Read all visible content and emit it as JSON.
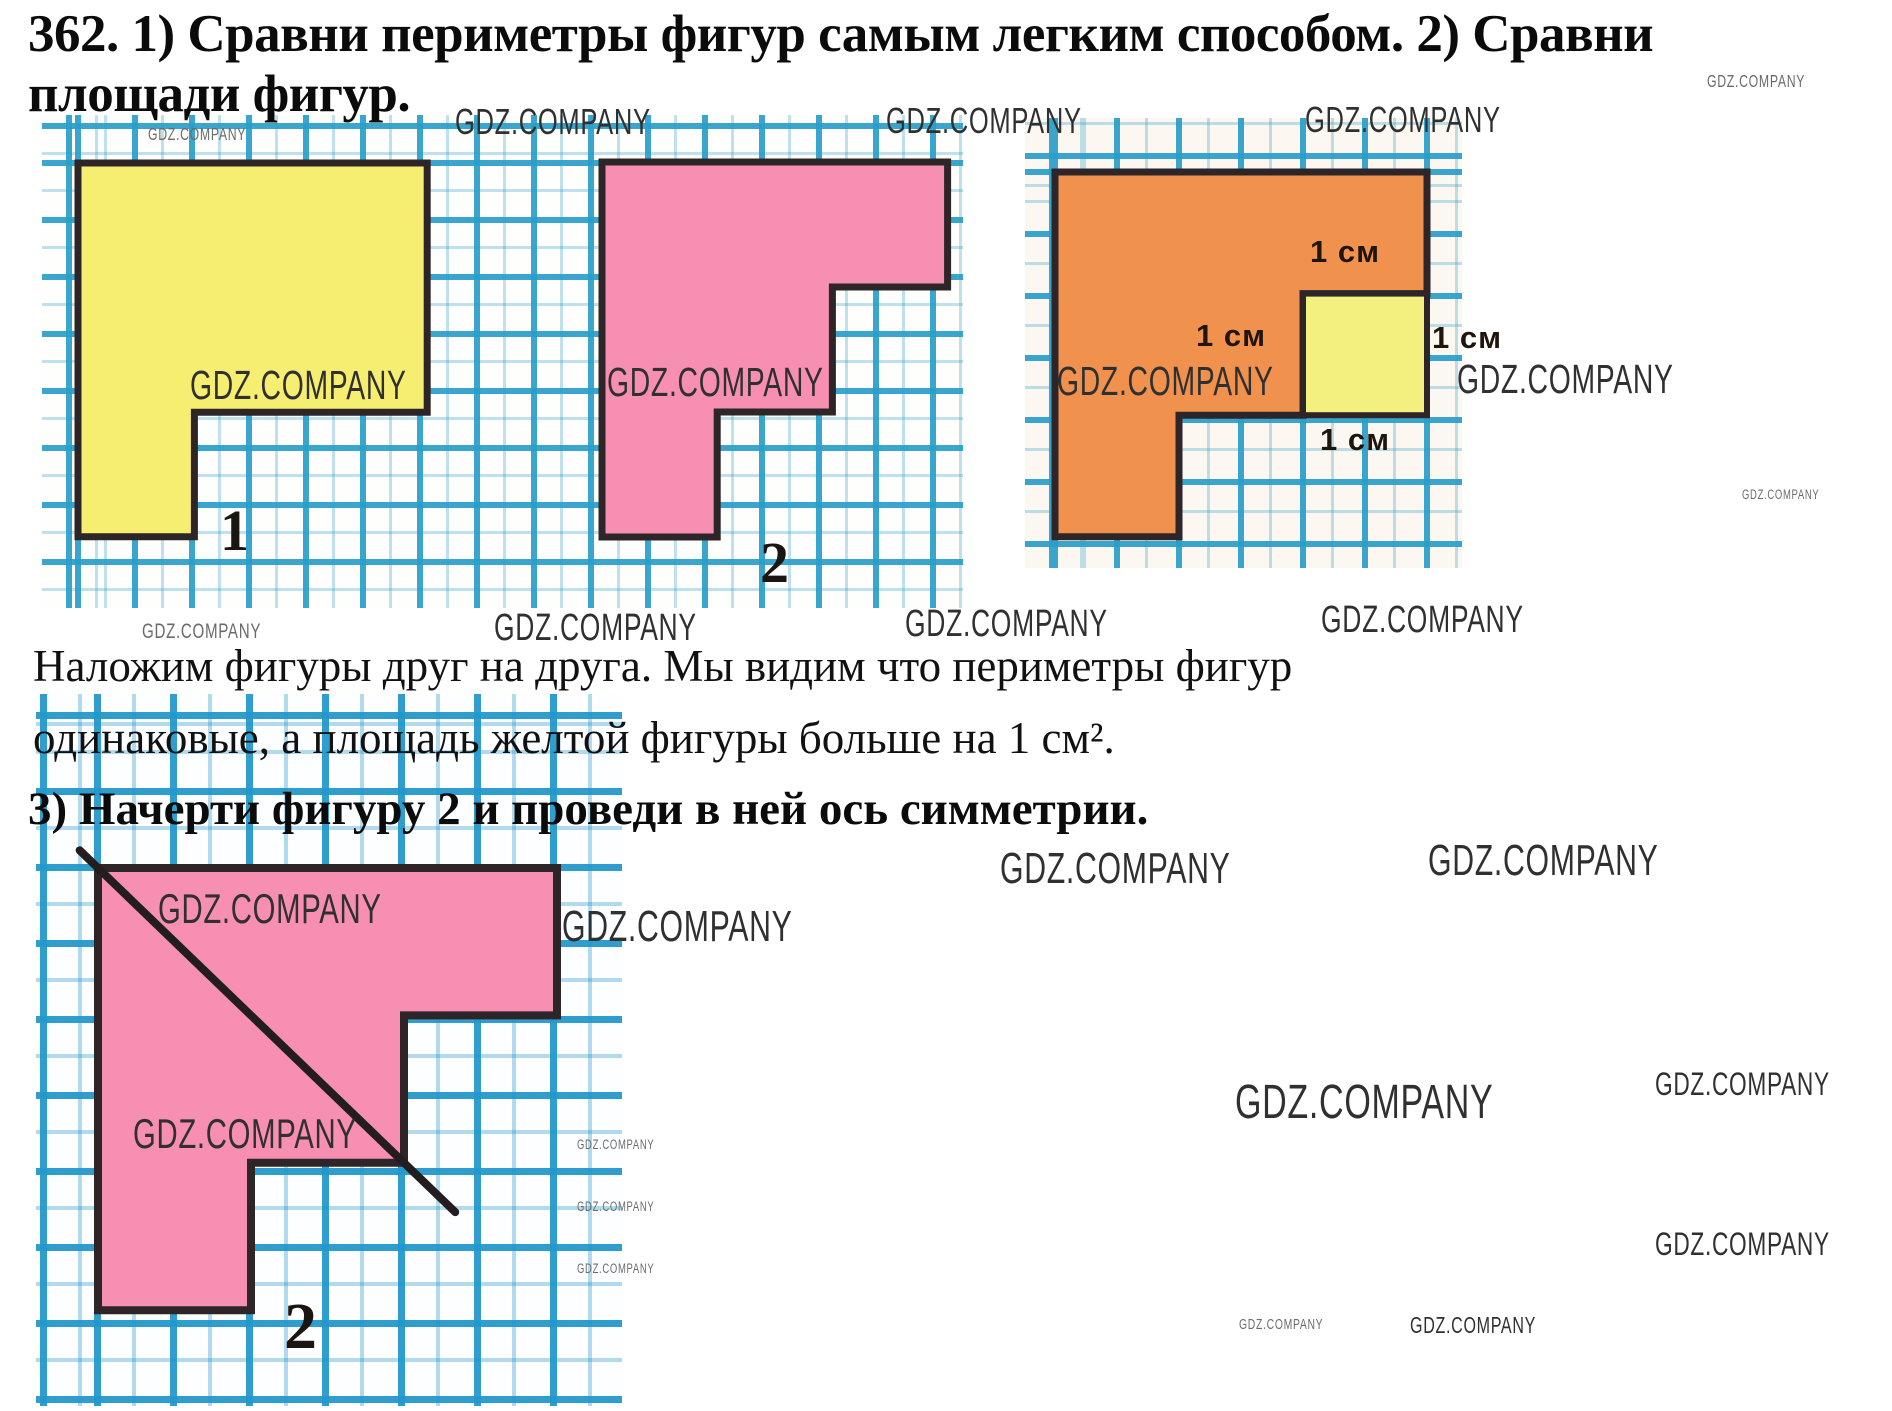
{
  "page": {
    "title_line1": "362. 1) Сравни периметры фигур самым легким способом. 2) Сравни",
    "title_line2": "площади фигур.",
    "solution_line1": "Наложим фигуры друг на друга. Мы видим что периметры фигур",
    "solution_line2": "одинаковые, а площадь желтой фигуры больше на 1 см².",
    "part3_heading": "3) Начерти фигуру 2 и проведи в ней ось симметрии."
  },
  "colors": {
    "grid_line": "#299EC9",
    "figure_outline": "#2e2528",
    "yellow_fill": "#f5ee71",
    "pink_fill": "#f78fb3",
    "orange_fill": "#f1914e",
    "small_square_yellow": "#f4f07f",
    "axis_line": "#241d20",
    "text": "#0d0d0d",
    "watermark_dark": "#303030",
    "watermark_gray": "#6b6b6b"
  },
  "figures": [
    {
      "name": "figure-1-yellow",
      "fill": "#f5ee71",
      "outline": "#2e2528",
      "stroke_width": 7,
      "origin": [
        78,
        163
      ],
      "unit": [
        58.2,
        62.3
      ],
      "polygon_units": [
        [
          0,
          0
        ],
        [
          6,
          0
        ],
        [
          6,
          4
        ],
        [
          2,
          4
        ],
        [
          2,
          6
        ],
        [
          0,
          6
        ]
      ]
    },
    {
      "name": "figure-2-pink",
      "fill": "#f78fb3",
      "outline": "#2e2528",
      "stroke_width": 7,
      "origin": [
        602,
        162
      ],
      "unit": [
        57.6,
        62.5
      ],
      "polygon_units": [
        [
          0,
          0
        ],
        [
          6,
          0
        ],
        [
          6,
          2
        ],
        [
          4,
          2
        ],
        [
          4,
          4
        ],
        [
          2,
          4
        ],
        [
          2,
          6
        ],
        [
          0,
          6
        ]
      ]
    },
    {
      "name": "figure-3-orange-overlay",
      "fill": "#f1914e",
      "outline": "#2e2528",
      "stroke_width": 7,
      "origin": [
        1055,
        172
      ],
      "unit": [
        62,
        60.8
      ],
      "polygon_units": [
        [
          0,
          0
        ],
        [
          6,
          0
        ],
        [
          6,
          2
        ],
        [
          4,
          2
        ],
        [
          4,
          4
        ],
        [
          2,
          4
        ],
        [
          2,
          6
        ],
        [
          0,
          6
        ]
      ],
      "inner_square": {
        "from": [
          4,
          2
        ],
        "to": [
          6,
          4
        ],
        "fill": "#f4f07f",
        "stroke_width": 6
      }
    },
    {
      "name": "figure-2-with-symmetry-axis",
      "fill": "#f78fb3",
      "outline": "#2e2528",
      "stroke_width": 8,
      "origin": [
        98,
        868
      ],
      "unit": [
        76.5,
        73.7
      ],
      "polygon_units": [
        [
          0,
          0
        ],
        [
          6,
          0
        ],
        [
          6,
          2
        ],
        [
          4,
          2
        ],
        [
          4,
          4
        ],
        [
          2,
          4
        ],
        [
          2,
          6
        ],
        [
          0,
          6
        ]
      ],
      "axis_line": {
        "from": [
          -0.24,
          -0.24
        ],
        "to": [
          4.67,
          4.67
        ],
        "stroke_width": 8,
        "color": "#241d20"
      }
    }
  ],
  "figure_number_labels": [
    {
      "text": "1",
      "x": 220,
      "y": 502,
      "size": 58
    },
    {
      "text": "2",
      "x": 760,
      "y": 534,
      "size": 58
    },
    {
      "text": "2",
      "x": 284,
      "y": 1294,
      "size": 66
    }
  ],
  "dimension_labels": [
    {
      "text": "1 см",
      "x": 1310,
      "y": 236
    },
    {
      "text": "1 см",
      "x": 1196,
      "y": 320
    },
    {
      "text": "1 см",
      "x": 1432,
      "y": 322
    },
    {
      "text": "1 см",
      "x": 1320,
      "y": 424
    }
  ],
  "watermarks": [
    {
      "text": "GDZ.COMPANY",
      "x": 455,
      "y": 104,
      "size": 27,
      "shade": "dark"
    },
    {
      "text": "GDZ.COMPANY",
      "x": 886,
      "y": 103,
      "size": 27,
      "shade": "dark"
    },
    {
      "text": "GDZ.COMPANY",
      "x": 1305,
      "y": 102,
      "size": 27,
      "shade": "dark"
    },
    {
      "text": "GDZ.COMPANY",
      "x": 1707,
      "y": 73,
      "size": 13,
      "shade": "gray"
    },
    {
      "text": "GDZ.COMPANY",
      "x": 148,
      "y": 126,
      "size": 13,
      "shade": "gray"
    },
    {
      "text": "GDZ.COMPANY",
      "x": 190,
      "y": 365,
      "size": 30,
      "shade": "dark"
    },
    {
      "text": "GDZ.COMPANY",
      "x": 607,
      "y": 362,
      "size": 30,
      "shade": "dark"
    },
    {
      "text": "GDZ.COMPANY",
      "x": 1057,
      "y": 361,
      "size": 30,
      "shade": "dark"
    },
    {
      "text": "GDZ.COMPANY",
      "x": 1457,
      "y": 359,
      "size": 30,
      "shade": "dark"
    },
    {
      "text": "GDZ.COMPANY",
      "x": 1742,
      "y": 488,
      "size": 10,
      "shade": "gray"
    },
    {
      "text": "GDZ.COMPANY",
      "x": 142,
      "y": 620,
      "size": 16,
      "shade": "gray"
    },
    {
      "text": "GDZ.COMPANY",
      "x": 494,
      "y": 610,
      "size": 28,
      "shade": "dark"
    },
    {
      "text": "GDZ.COMPANY",
      "x": 905,
      "y": 606,
      "size": 28,
      "shade": "dark"
    },
    {
      "text": "GDZ.COMPANY",
      "x": 1321,
      "y": 602,
      "size": 28,
      "shade": "dark"
    },
    {
      "text": "GDZ.COMPANY",
      "x": 1000,
      "y": 848,
      "size": 32,
      "shade": "dark"
    },
    {
      "text": "GDZ.COMPANY",
      "x": 1428,
      "y": 840,
      "size": 32,
      "shade": "dark"
    },
    {
      "text": "GDZ.COMPANY",
      "x": 158,
      "y": 888,
      "size": 31,
      "shade": "dark"
    },
    {
      "text": "GDZ.COMPANY",
      "x": 133,
      "y": 1113,
      "size": 31,
      "shade": "dark"
    },
    {
      "text": "GDZ.COMPANY",
      "x": 562,
      "y": 906,
      "size": 32,
      "shade": "dark"
    },
    {
      "text": "GDZ.COMPANY",
      "x": 577,
      "y": 1138,
      "size": 10,
      "shade": "gray"
    },
    {
      "text": "GDZ.COMPANY",
      "x": 577,
      "y": 1200,
      "size": 10,
      "shade": "gray"
    },
    {
      "text": "GDZ.COMPANY",
      "x": 577,
      "y": 1262,
      "size": 10,
      "shade": "gray"
    },
    {
      "text": "GDZ.COMPANY",
      "x": 1235,
      "y": 1078,
      "size": 36,
      "shade": "dark"
    },
    {
      "text": "GDZ.COMPANY",
      "x": 1655,
      "y": 1068,
      "size": 24,
      "shade": "dark"
    },
    {
      "text": "GDZ.COMPANY",
      "x": 1655,
      "y": 1228,
      "size": 24,
      "shade": "dark"
    },
    {
      "text": "GDZ.COMPANY",
      "x": 1239,
      "y": 1318,
      "size": 11,
      "shade": "gray"
    },
    {
      "text": "GDZ.COMPANY",
      "x": 1410,
      "y": 1314,
      "size": 17,
      "shade": "dark"
    }
  ]
}
